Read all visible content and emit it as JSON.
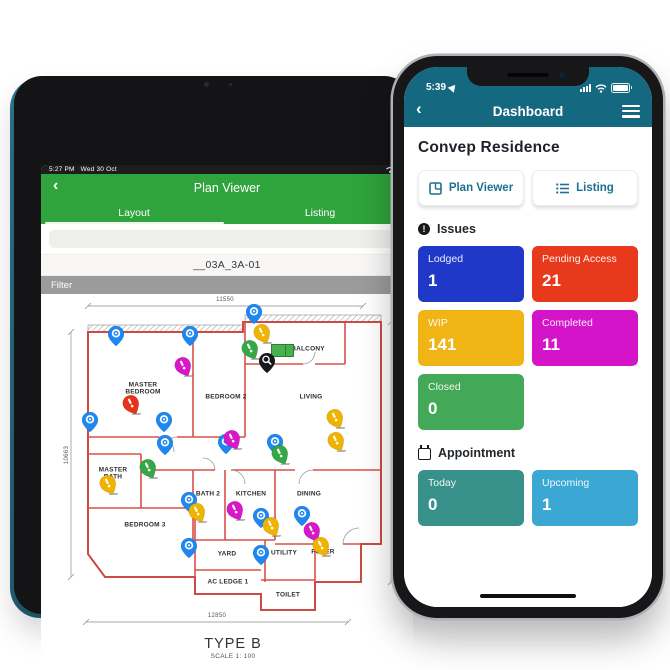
{
  "tablet": {
    "status_bar": {
      "time": "5:27 PM",
      "date": "Wed 30 Oct",
      "battery": "66"
    },
    "nav": {
      "back": "‹",
      "title": "Plan Viewer"
    },
    "tabs": [
      {
        "label": "Layout",
        "active": true
      },
      {
        "label": "Listing",
        "active": false
      }
    ],
    "search": {
      "placeholder": ""
    },
    "unit_label": "__03A_3A-01",
    "filter_label": "Filter",
    "plan": {
      "title": "TYPE B",
      "scale": "SCALE 1: 100",
      "dimensions": {
        "top": "11550",
        "bottom": "12850",
        "left": "10663",
        "right": "12425"
      },
      "rooms": [
        {
          "lines": [
            "MASTER",
            "BEDROOM"
          ],
          "x": 80,
          "y": 97
        },
        {
          "lines": [
            "BEDROOM 2"
          ],
          "x": 163,
          "y": 105
        },
        {
          "lines": [
            "LIVING"
          ],
          "x": 248,
          "y": 105
        },
        {
          "lines": [
            "BALCONY"
          ],
          "x": 245,
          "y": 57
        },
        {
          "lines": [
            "MASTER",
            "BATH"
          ],
          "x": 50,
          "y": 182
        },
        {
          "lines": [
            "BATH 2"
          ],
          "x": 145,
          "y": 202
        },
        {
          "lines": [
            "KITCHEN"
          ],
          "x": 188,
          "y": 202
        },
        {
          "lines": [
            "DINING"
          ],
          "x": 246,
          "y": 202
        },
        {
          "lines": [
            "BEDROOM 3"
          ],
          "x": 82,
          "y": 233
        },
        {
          "lines": [
            "YARD"
          ],
          "x": 164,
          "y": 262
        },
        {
          "lines": [
            "UTILITY"
          ],
          "x": 221,
          "y": 261
        },
        {
          "lines": [
            "FOYER"
          ],
          "x": 260,
          "y": 260
        },
        {
          "lines": [
            "AC LEDGE 1"
          ],
          "x": 165,
          "y": 290
        },
        {
          "lines": [
            "TOILET"
          ],
          "x": 225,
          "y": 303
        }
      ],
      "pin_colors": {
        "blue": "#1e88f0",
        "yellow": "#f0b400",
        "green": "#35a845",
        "magenta": "#d818c8",
        "red": "#e8321a",
        "black": "#17181a"
      },
      "pins": [
        {
          "t": "blue",
          "x": 191,
          "y": 31
        },
        {
          "t": "blue",
          "x": 53,
          "y": 53
        },
        {
          "t": "blue",
          "x": 127,
          "y": 53
        },
        {
          "t": "yellow",
          "x": 204,
          "y": 50
        },
        {
          "t": "greenbox",
          "x": 208,
          "y": 52
        },
        {
          "t": "green",
          "x": 192,
          "y": 66
        },
        {
          "t": "black",
          "x": 204,
          "y": 80
        },
        {
          "t": "magenta",
          "x": 125,
          "y": 83
        },
        {
          "t": "red",
          "x": 73,
          "y": 121
        },
        {
          "t": "yellow",
          "x": 277,
          "y": 135
        },
        {
          "t": "blue",
          "x": 27,
          "y": 139
        },
        {
          "t": "blue",
          "x": 101,
          "y": 139
        },
        {
          "t": "blue",
          "x": 102,
          "y": 162
        },
        {
          "t": "blue",
          "x": 163,
          "y": 161
        },
        {
          "t": "magenta",
          "x": 174,
          "y": 156
        },
        {
          "t": "blue",
          "x": 212,
          "y": 161
        },
        {
          "t": "green",
          "x": 222,
          "y": 171
        },
        {
          "t": "yellow",
          "x": 278,
          "y": 158
        },
        {
          "t": "green",
          "x": 90,
          "y": 185
        },
        {
          "t": "yellow",
          "x": 50,
          "y": 201
        },
        {
          "t": "blue",
          "x": 126,
          "y": 219
        },
        {
          "t": "yellow",
          "x": 139,
          "y": 229
        },
        {
          "t": "magenta",
          "x": 177,
          "y": 227
        },
        {
          "t": "blue",
          "x": 198,
          "y": 235
        },
        {
          "t": "blue",
          "x": 239,
          "y": 233
        },
        {
          "t": "yellow",
          "x": 213,
          "y": 243
        },
        {
          "t": "magenta",
          "x": 254,
          "y": 248
        },
        {
          "t": "yellow",
          "x": 263,
          "y": 263
        },
        {
          "t": "blue",
          "x": 126,
          "y": 265
        },
        {
          "t": "blue",
          "x": 198,
          "y": 272
        }
      ]
    }
  },
  "phone": {
    "status_bar": {
      "time": "5:39"
    },
    "nav": {
      "back": "‹",
      "title": "Dashboard"
    },
    "project_title": "Convep Residence",
    "buttons": [
      {
        "label": "Plan Viewer"
      },
      {
        "label": "Listing"
      }
    ],
    "sections": [
      {
        "title": "Issues",
        "tiles": [
          {
            "label": "Lodged",
            "value": "1",
            "color": "#2038c8"
          },
          {
            "label": "Pending Access",
            "value": "21",
            "color": "#e8391c"
          },
          {
            "label": "WIP",
            "value": "141",
            "color": "#f0b414"
          },
          {
            "label": "Completed",
            "value": "11",
            "color": "#d414c8"
          },
          {
            "label": "Closed",
            "value": "0",
            "color": "#43a857"
          }
        ]
      },
      {
        "title": "Appointment",
        "tiles": [
          {
            "label": "Today",
            "value": "0",
            "color": "#37918a"
          },
          {
            "label": "Upcoming",
            "value": "1",
            "color": "#3aa8d2"
          }
        ]
      }
    ]
  },
  "colors": {
    "tablet_green": "#2fa33c",
    "phone_teal": "#146880",
    "filter_gray": "#9b9b9b"
  }
}
